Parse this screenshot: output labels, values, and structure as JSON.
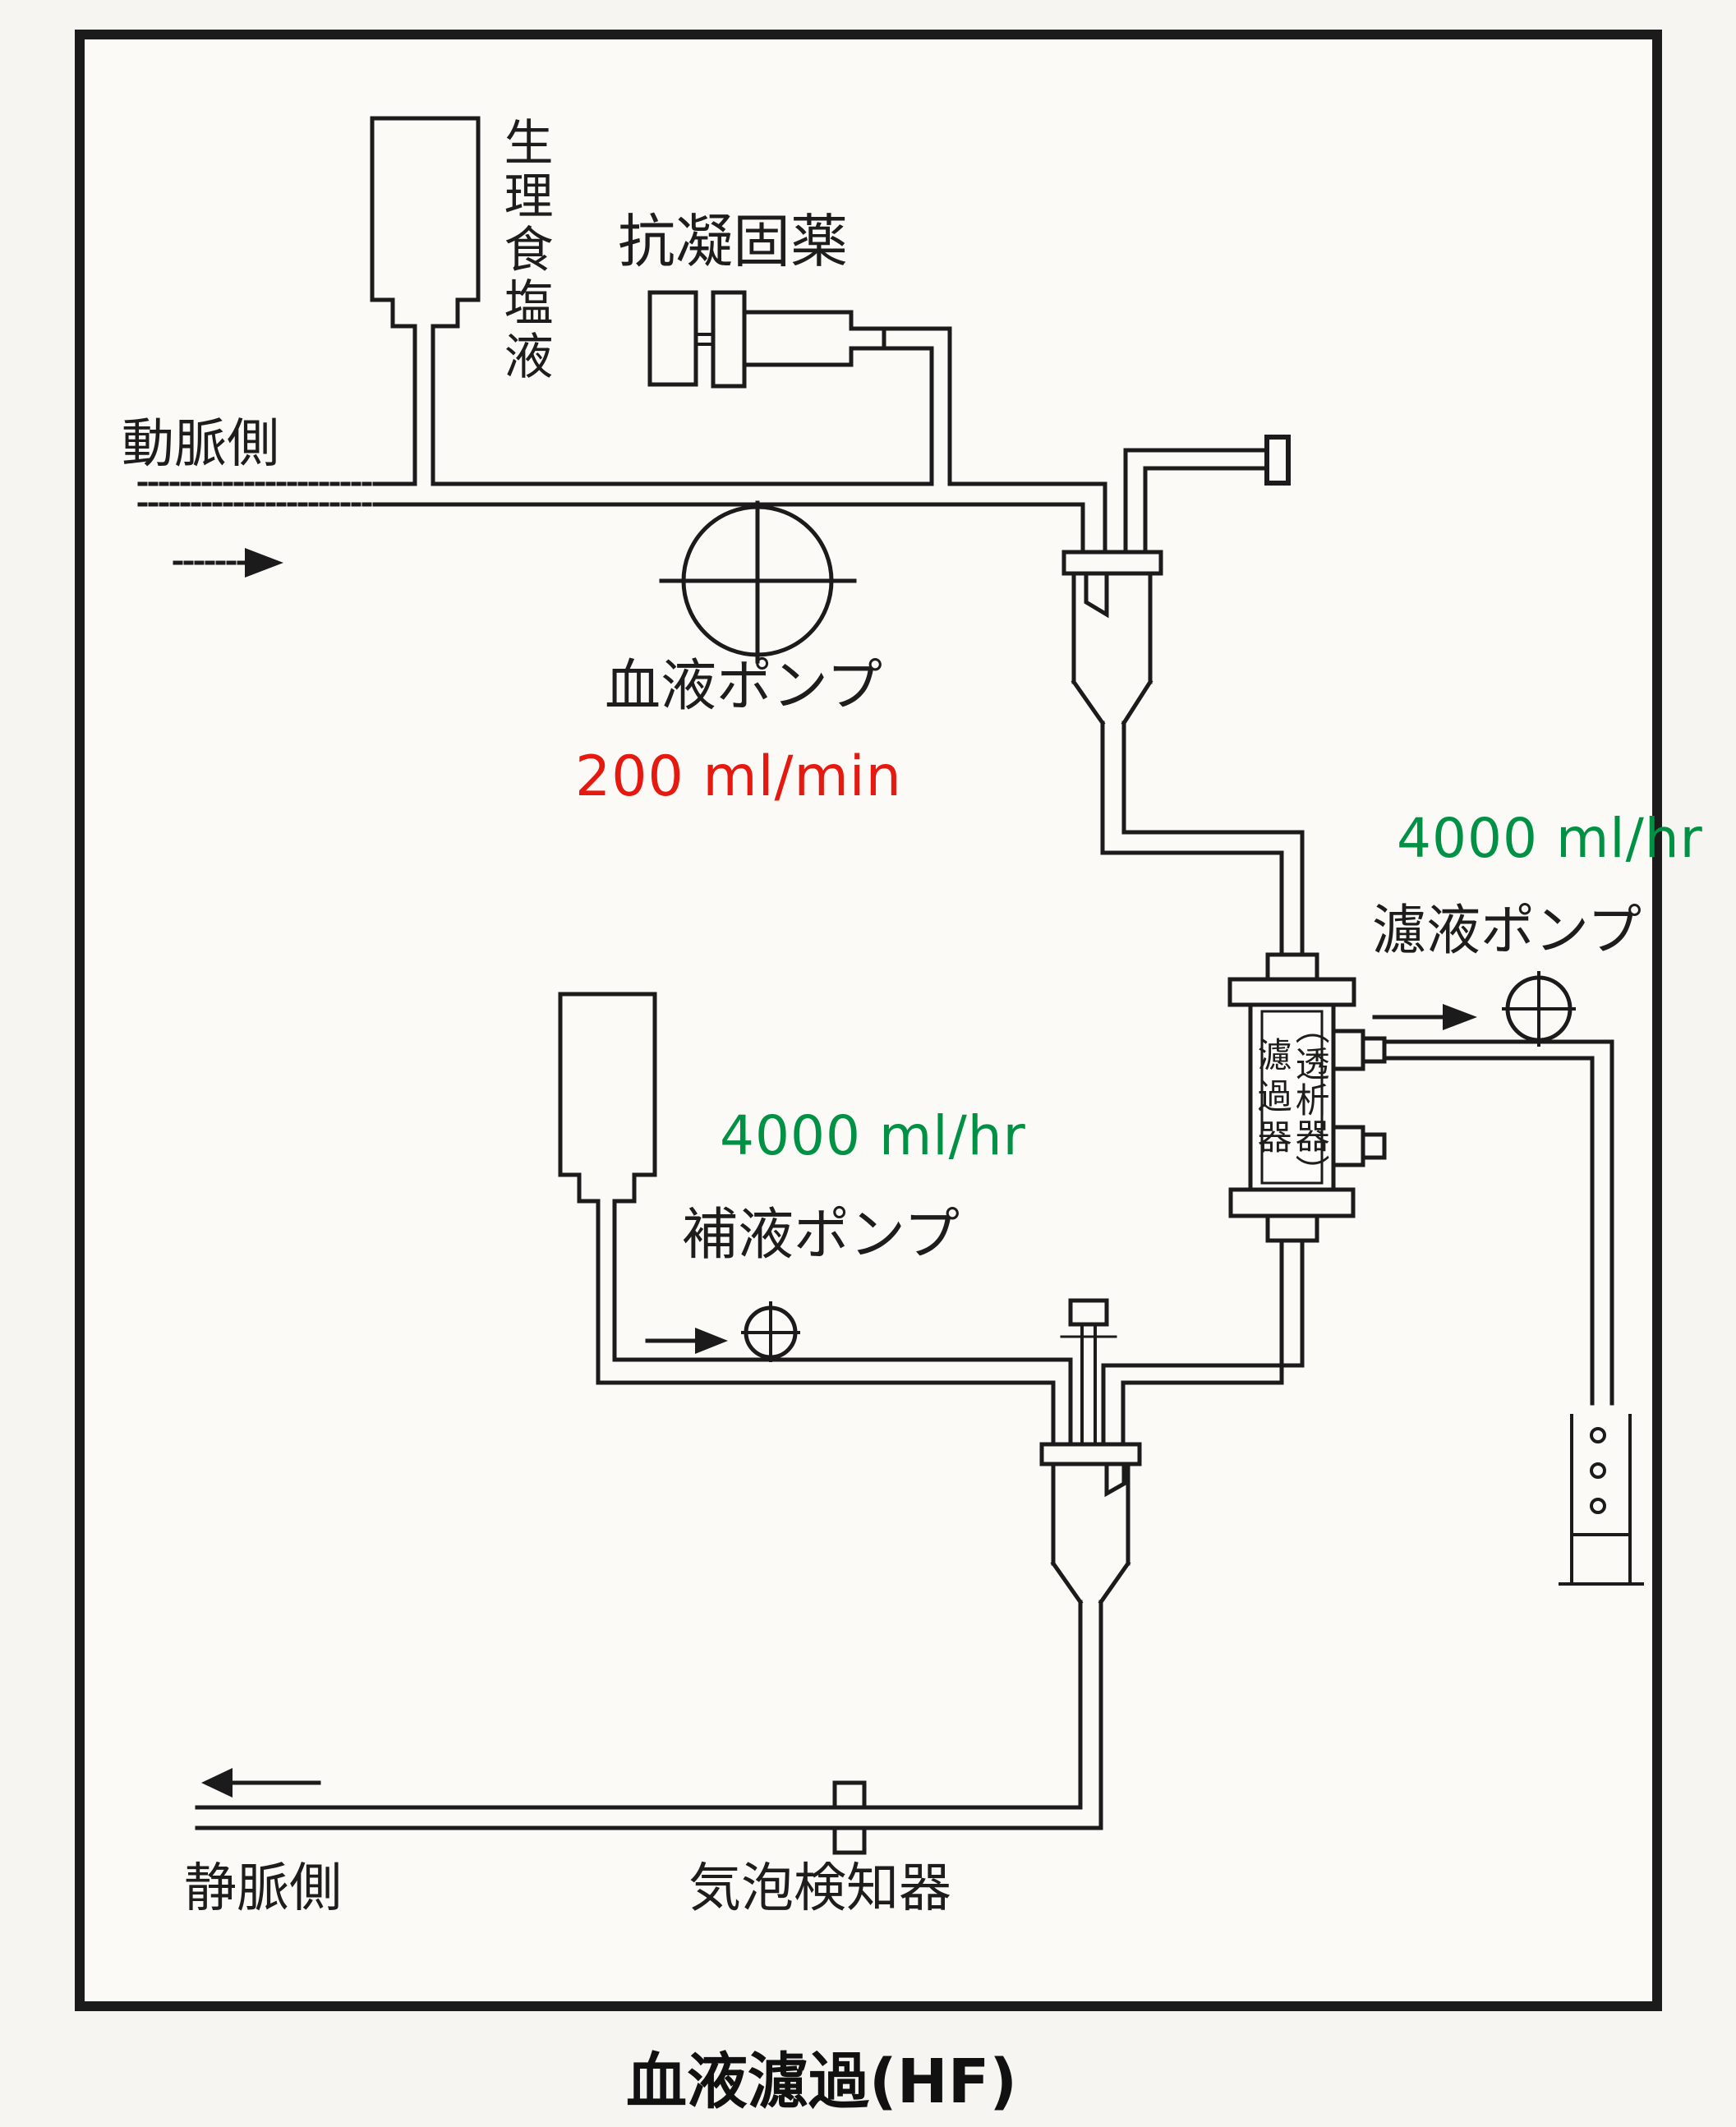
{
  "title": "血液濾過(HF)",
  "labels": {
    "arterial_side": "動脈側",
    "saline": "生理食塩液",
    "anticoagulant": "抗凝固薬",
    "blood_pump": "血液ポンプ",
    "filtrate_pump": "濾液ポンプ",
    "replacement_pump": "補液ポンプ",
    "dialyzer_secondary": "（透析器）",
    "dialyzer_primary": "濾過器",
    "venous_side": "静脈側",
    "bubble_detector": "気泡検知器"
  },
  "rates": {
    "blood_pump_rate": "200 ml/min",
    "filtrate_rate": "4000 ml/hr",
    "replacement_rate": "4000 ml/hr"
  },
  "colors": {
    "line": "#1b1b1b",
    "text": "#1d1d1d",
    "rate_red": "#e61910",
    "rate_green": "#009145"
  }
}
